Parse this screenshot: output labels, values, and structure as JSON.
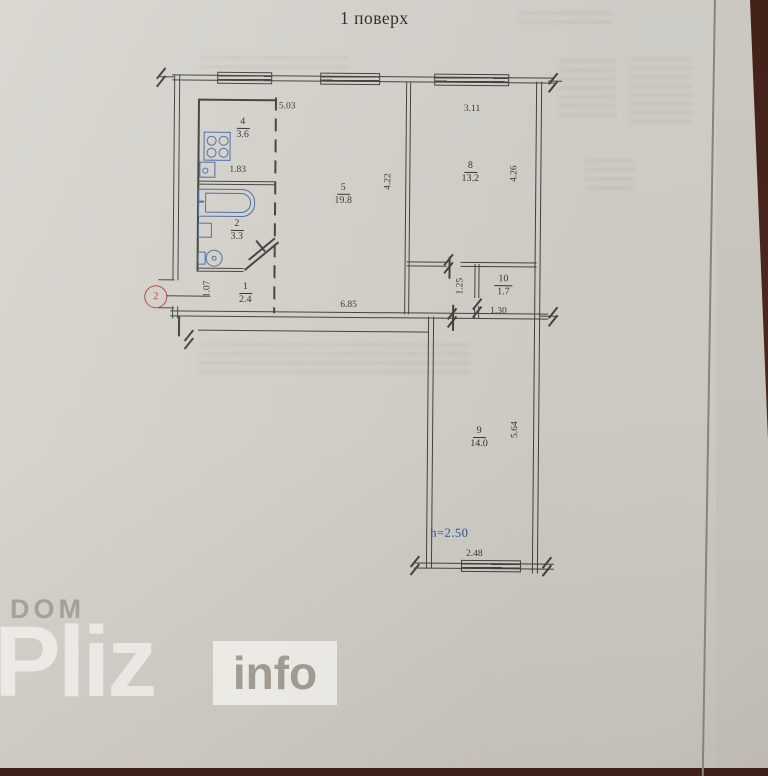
{
  "page": {
    "title": "1 поверх"
  },
  "watermark": {
    "dom": "DOM",
    "pliz": "Pliz",
    "info": "info"
  },
  "plan": {
    "marker_label": "2",
    "rooms": {
      "kitchen": {
        "number": "4",
        "area": "3.6"
      },
      "bathroom": {
        "number": "2",
        "area": "3.3"
      },
      "hallway": {
        "number": "1",
        "area": "2.4"
      },
      "living_room": {
        "number": "5",
        "area": "19.8"
      },
      "bedroom": {
        "number": "8",
        "area": "13.2"
      },
      "storage": {
        "number": "10",
        "area": "1.7"
      },
      "lower_room": {
        "number": "9",
        "area": "14.0"
      }
    },
    "dimensions": {
      "kitchen_top": "5.03",
      "kitchen_inner": "1.83",
      "bedroom_top": "3.11",
      "living_height": "4.22",
      "bedroom_height": "4.26",
      "entry_width": "1.07",
      "bottom_width": "6.85",
      "corridor_width": "1.25",
      "storage_width": "1.30",
      "lower_room_height": "5.64",
      "lower_room_width": "2.48",
      "ceiling_height": "h=2.50"
    },
    "colors": {
      "ink": "#44423e",
      "fixture_blue": "#4c6da6",
      "note_blue": "#2d4f8a",
      "marker_red": "#ae4d3a"
    }
  }
}
